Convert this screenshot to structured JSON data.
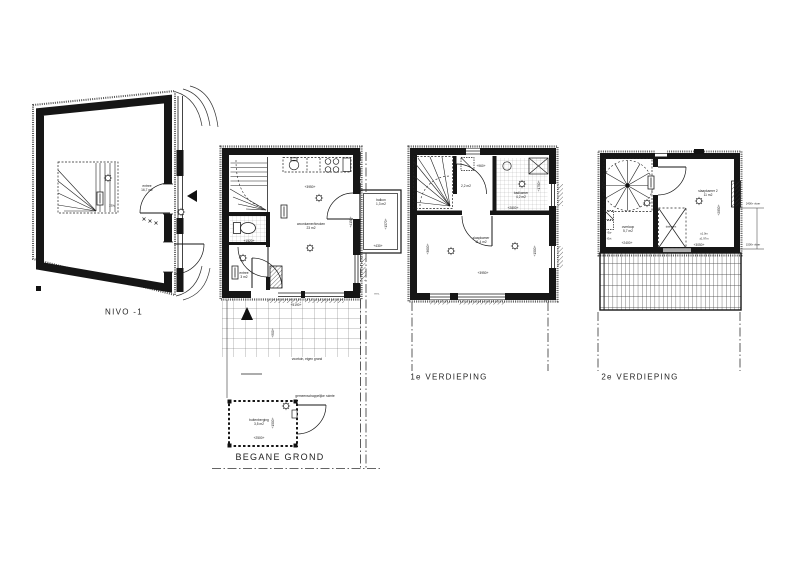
{
  "drawing": {
    "background": "#ffffff",
    "line": "#1a1a1a"
  },
  "nivo1": {
    "title": "NIVO -1",
    "entree": {
      "name": "entree",
      "area": "16,7 m2"
    },
    "outlet": "230v"
  },
  "begane_grond": {
    "title": "BEGANE GROND",
    "woonkamer": {
      "name": "woonkamer/keuken",
      "area": "23 m2"
    },
    "entree": {
      "name": "entree",
      "area": "3 m2"
    },
    "balkon": {
      "name": "balkon",
      "area": "1,3 m2"
    },
    "berging": {
      "name": "buitenberging",
      "area": "3,5 m2"
    },
    "voortuin": "voortuin, eigen grond",
    "gemeenschappelijk": "gemeenschappelijke ruimte",
    "meter_note": "m.v.",
    "dims": {
      "breedte": "+3950+",
      "diepte": "+4150+",
      "hal": "+1520+",
      "gevel": "+5190+",
      "tuin": "+900+",
      "balkon_diepte": "+1570+",
      "balkon_breedte": "+430+",
      "berging_diepte": "+1500+",
      "berging_breedte": "+2500+"
    }
  },
  "verdieping1": {
    "title": "1e VERDIEPING",
    "hal_area": "2,2 m2",
    "badkamer": {
      "name": "badkamer",
      "area": "4,2 m2"
    },
    "slaapkamer": {
      "name": "slaapkamer",
      "area": "11,4 m2"
    },
    "meter_note": "m.v.",
    "dims": {
      "kast": "+960+",
      "badkamer_breedte": "+2800+",
      "badkamer_diepte": "+1750+",
      "links": "+3600+",
      "rechts": "+1500+",
      "breedte": "+3950+"
    }
  },
  "verdieping2": {
    "title": "2e VERDIEPING",
    "overloop": {
      "name": "overloop",
      "area": "5,7 m2"
    },
    "slaapkamer2": {
      "name": "slaapkamer 2",
      "area": "11 m2"
    },
    "dakraam": "dakraam",
    "hoogte1": "±1.0m",
    "hoogte2": "±1.97m",
    "vloer1": "2400+ vloer",
    "vloer2": "1500+ vloer",
    "ew": "-Ew",
    "evt": "-Evt",
    "dims": {
      "overloop_breedte": "+2400+",
      "slaapkamer_breedte": "+3050+",
      "slaapkamer_diepte": "+2850+"
    }
  }
}
